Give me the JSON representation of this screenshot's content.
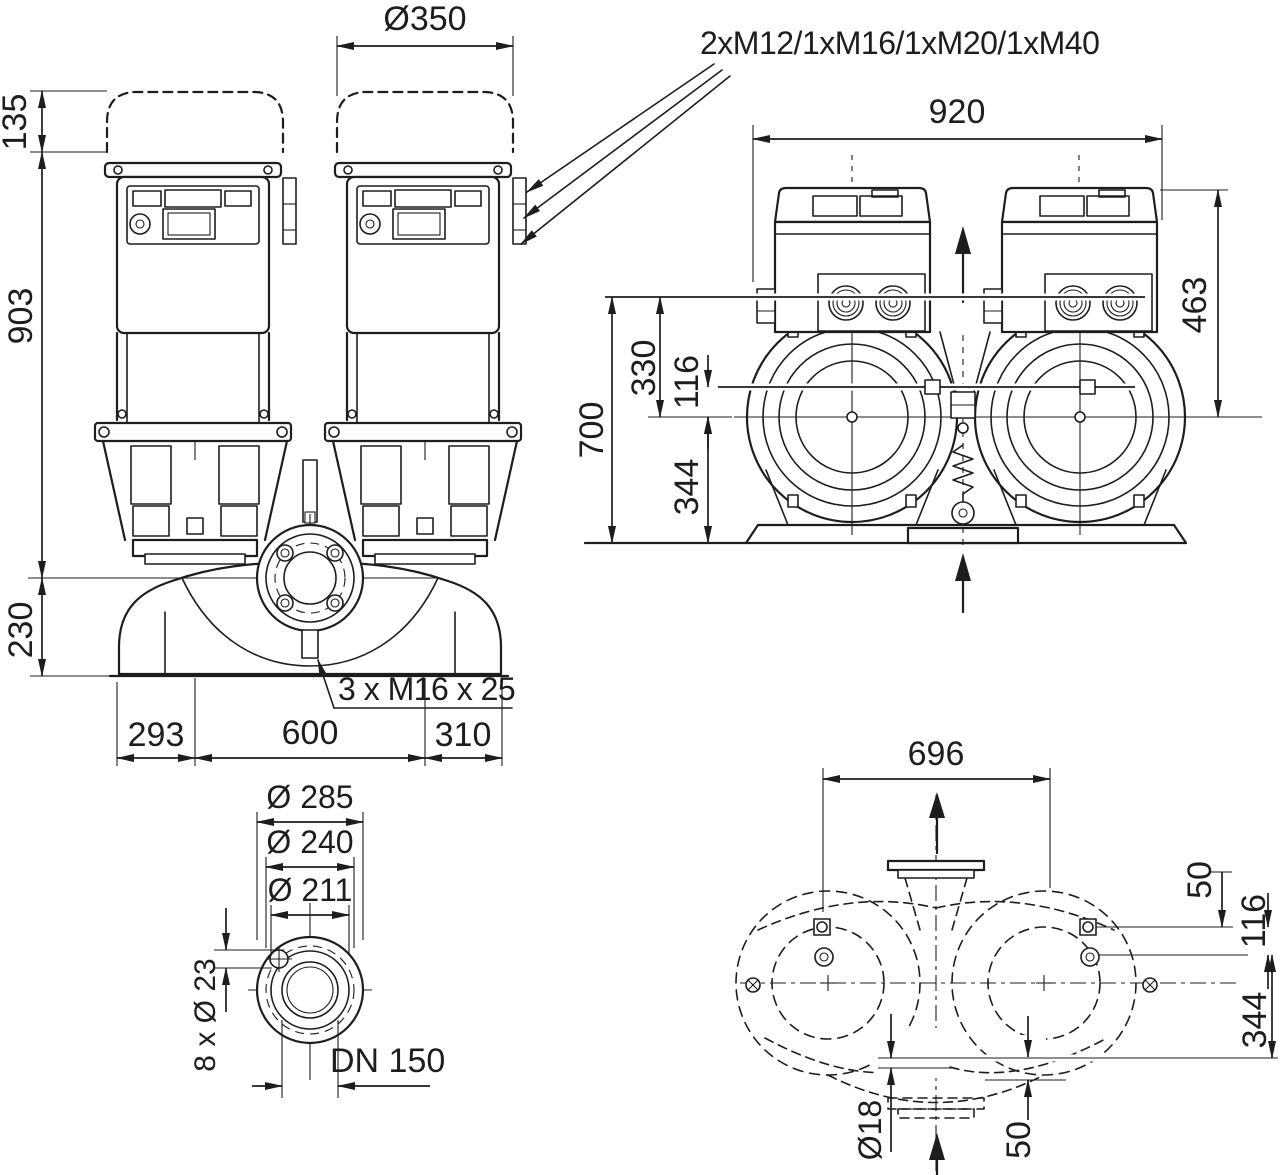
{
  "page": {
    "background": "#ffffff",
    "ink": "#1d1d1b"
  },
  "annotations": {
    "cable_glands": "2xM12/1xM16/1xM20/1xM40",
    "tapped_holes": "3 x M16 x 25"
  },
  "front_view": {
    "cap_diameter": "Ø350",
    "cap_height": "135",
    "module_to_axis": "903",
    "axis_to_base": "230",
    "base_left": "293",
    "pump_spacing": "600",
    "base_right": "310"
  },
  "side_view": {
    "overall_width": "920",
    "axis_to_top": "463",
    "overall_height": "700",
    "dim_330": "330",
    "dim_116": "116",
    "dim_344": "344"
  },
  "flange_view": {
    "outer_diameter": "Ø 285",
    "bolt_circle": "Ø 240",
    "raised_face": "Ø 211",
    "bolt_holes": "8 x Ø 23",
    "nominal_diameter": "DN 150"
  },
  "plan_view": {
    "bolt_spacing": "696",
    "dim_50_top": "50",
    "dim_116": "116",
    "dim_344": "344",
    "anchor_hole": "Ø18",
    "dim_50_bottom": "50"
  }
}
